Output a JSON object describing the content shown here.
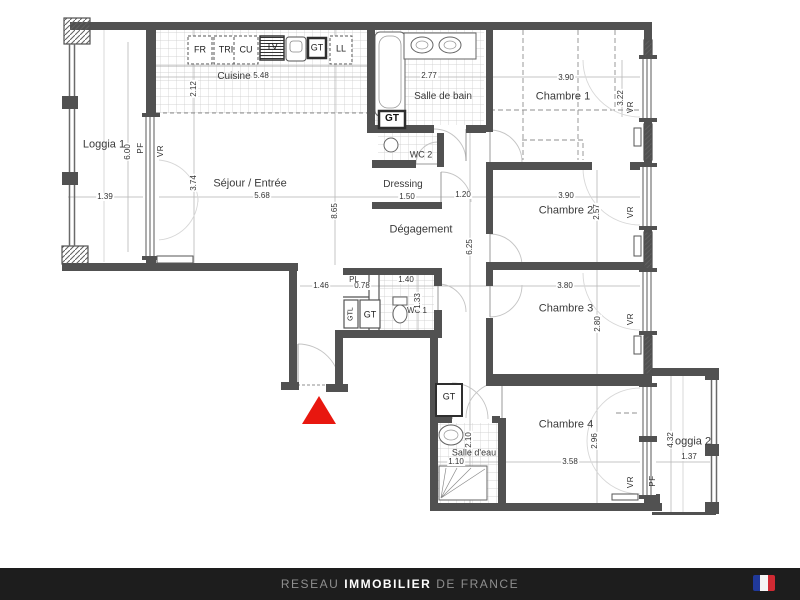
{
  "rooms": {
    "loggia1": "Loggia 1",
    "cuisine": "Cuisine",
    "sejour": "Séjour / Entrée",
    "salle_de_bain": "Salle de bain",
    "chambre1": "Chambre 1",
    "wc2": "WC 2",
    "dressing": "Dressing",
    "degagement": "Dégagement",
    "chambre2": "Chambre 2",
    "chambre3": "Chambre 3",
    "chambre4": "Chambre 4",
    "salle_deau": "Salle d'eau",
    "wc1": "WC 1",
    "loggia2": "Loggia 2"
  },
  "equipment": {
    "fr": "FR",
    "tri": "TRI",
    "cu": "CU",
    "tv": "TV",
    "ll": "LL",
    "gt": "GT",
    "gtl": "GTL",
    "pl": "PL"
  },
  "openings": {
    "vr": "VR",
    "pf": "PF"
  },
  "dims": {
    "loggia1_w": "1.39",
    "loggia1_h": "6.00",
    "cuisine_w": "5.48",
    "cuisine_d": "2.12",
    "sdb_w": "2.77",
    "ch1_w": "3.90",
    "ch1_d": "3.22",
    "sejour_w": "5.68",
    "sejour_d": "3.74",
    "sejour_h": "8.65",
    "dressing_w": "1.50",
    "hall_w": "1.20",
    "ch2_w": "3.90",
    "ch2_d": "2.57",
    "hall_h": "6.25",
    "vest_w": "1.46",
    "pl_w": "0.78",
    "wc1_w": "1.40",
    "wc1_h": "1.33",
    "ch3_w": "3.80",
    "ch3_d": "2.80",
    "ch4_w": "3.58",
    "ch4_d": "2.96",
    "sde_w": "1.10",
    "sde_h": "2.10",
    "loggia2_w": "1.37",
    "loggia2_h": "4.32"
  },
  "footer": {
    "brand_prefix": "RESEAU",
    "brand_main": "IMMOBILIER",
    "brand_suffix": "DE FRANCE"
  },
  "colors": {
    "wall": "#515151",
    "marker_red": "#e8170f",
    "footer_bg": "#1d1d1d",
    "flag_blue": "#20399a",
    "flag_white": "#f5f5f5",
    "flag_red": "#d02a33"
  }
}
